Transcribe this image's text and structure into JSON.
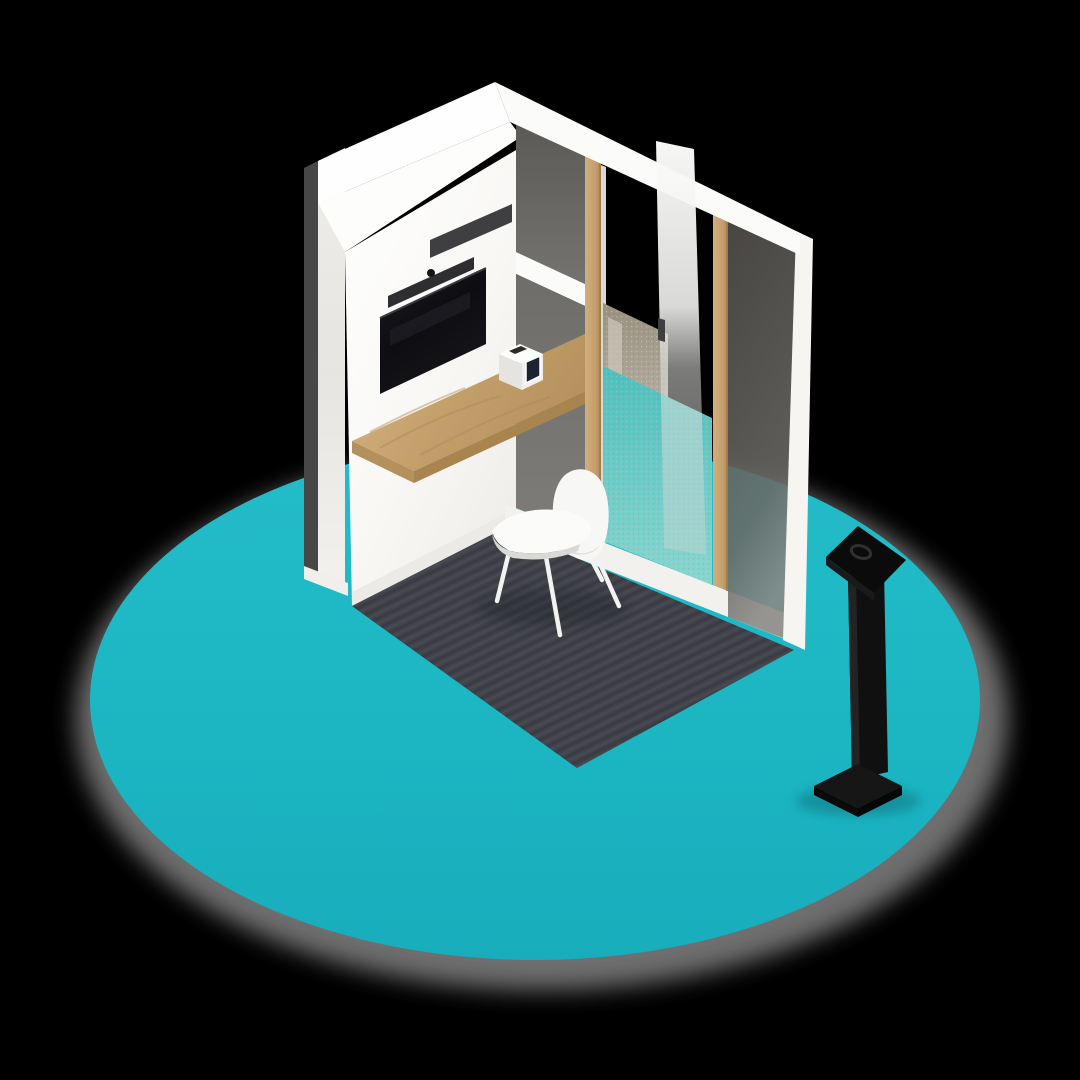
{
  "scene": {
    "description": "Isometric 3D render of a compact office phone booth standing on a teal circular platform, with an open glass door, wall-mounted screen, wooden desk shelf, white chair and a black tablet kiosk totem to the right",
    "background_color": "#000000"
  },
  "palette": {
    "teal_platform": "#1bb6c3",
    "teal_platform_light": "#22bfcb",
    "aqua_through_glass": "#5cc5c1",
    "aqua_through_glass_light": "#86d5cf",
    "wall_white": "#faf9f7",
    "wall_exterior": "#e9e7e3",
    "roof_white": "#fefefe",
    "baseboard_white": "#f2f1ee",
    "wood_desk": "#c5a271",
    "wood_frame": "#c9a675",
    "glass_smoked": "#6b6a66",
    "glass_smoked_dark": "#585753",
    "frosted_beige": "#a79f93",
    "carpet_dark": "#41424a",
    "carpet_stripe": "#35363c",
    "tv_black": "#101013",
    "soundbar_black": "#2e2e30",
    "kiosk_black": "#0c0c0c",
    "chair_white": "#f7f7f5",
    "shadow_gray": "#8a8a8a"
  },
  "platform": {
    "shape": "ellipse",
    "label": "teal floor disc"
  },
  "booth": {
    "label": "office phone booth",
    "parts": {
      "roof": "white flat roof slab",
      "left_wall": "white exterior wall edge",
      "back_wall": "white interior wall with screen",
      "screen": "wall mounted display",
      "soundbar": "soundbar with camera",
      "desk": "oak desk shelf",
      "tablet_stand": "white desk tablet stand",
      "glass_wall": "smoked glass wall with oak pillars",
      "door": "open glass door",
      "carpet": "dark ribbed carpet tile",
      "chair": "white shell chair"
    }
  },
  "kiosk": {
    "label": "black tablet kiosk totem"
  }
}
